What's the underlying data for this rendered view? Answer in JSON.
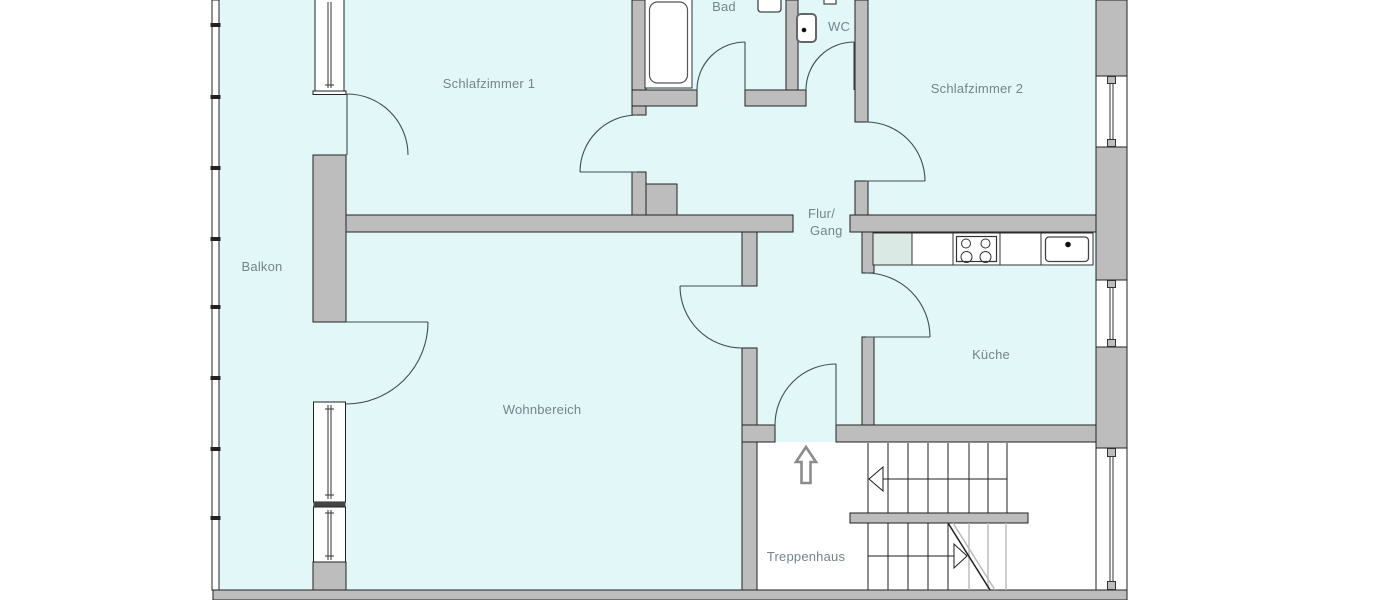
{
  "meta": {
    "title": "Wohnungsgrundriss",
    "type": "floor-plan",
    "language": "de"
  },
  "colors": {
    "floor": "#e2f7f7",
    "wall": "#bdbdbd",
    "outline": "#222222",
    "door": "#3f4d50",
    "label": "#74848c",
    "arrow": "#8c8c8c",
    "lightline": "#b8b8b8",
    "counteraccent": "#dbe9e5"
  },
  "rooms": {
    "balkon": {
      "label": "Balkon"
    },
    "schlafzimmer1": {
      "label": "Schlafzimmer 1"
    },
    "bad": {
      "label": "Bad"
    },
    "wc": {
      "label": "WC"
    },
    "schlafzimmer2": {
      "label": "Schlafzimmer 2"
    },
    "flur": {
      "label_line1": "Flur/",
      "label_line2": "Gang"
    },
    "kueche": {
      "label": "Küche"
    },
    "wohnbereich": {
      "label": "Wohnbereich"
    },
    "treppenhaus": {
      "label": "Treppenhaus"
    }
  }
}
